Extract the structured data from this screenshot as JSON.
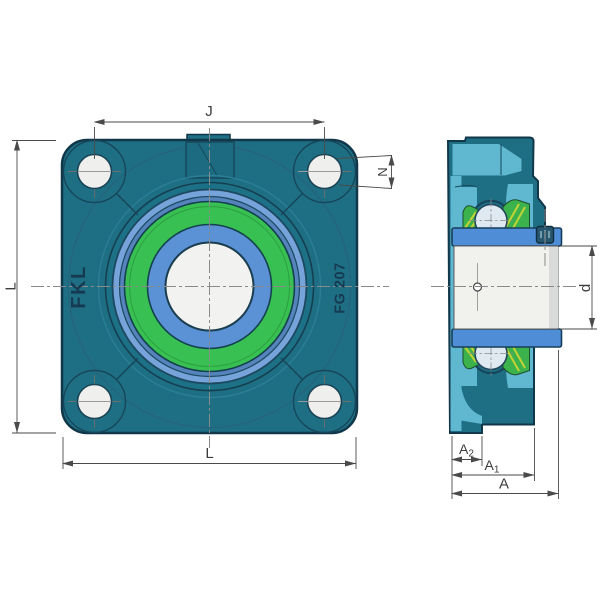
{
  "drawing": {
    "front_view": {
      "brand_text": "FKL",
      "model_text": "FG 207"
    },
    "dimension_labels": {
      "j": "J",
      "n": "N",
      "l_left": "L",
      "l_bottom": "L",
      "a": "A",
      "a1_main": "A",
      "a1_sub": "1",
      "a2_main": "A",
      "a2_sub": "2",
      "d": "d"
    },
    "colors": {
      "housing_teal": "#1e6f84",
      "housing_outline": "#11374a",
      "cut_face_light": "#5fb7d0",
      "bevel_teal": "#2a7e95",
      "ring_green": "#38c052",
      "ring_blue_inner": "#5b92d6",
      "ring_blue_mid": "#5584bc",
      "ring_blue_outer": "#76a3da",
      "sleeve_blue": "#4f8dd6",
      "seal_green": "#3cb24c",
      "seal_hatch_yellow": "#c2d435",
      "bearing_ball": "#dfe9f2",
      "shaft_face": "#f1f1ee",
      "set_screw": "#27566f",
      "dimension_line": "#4a4a4a",
      "centerline_gray": "#8a8a8a"
    }
  }
}
